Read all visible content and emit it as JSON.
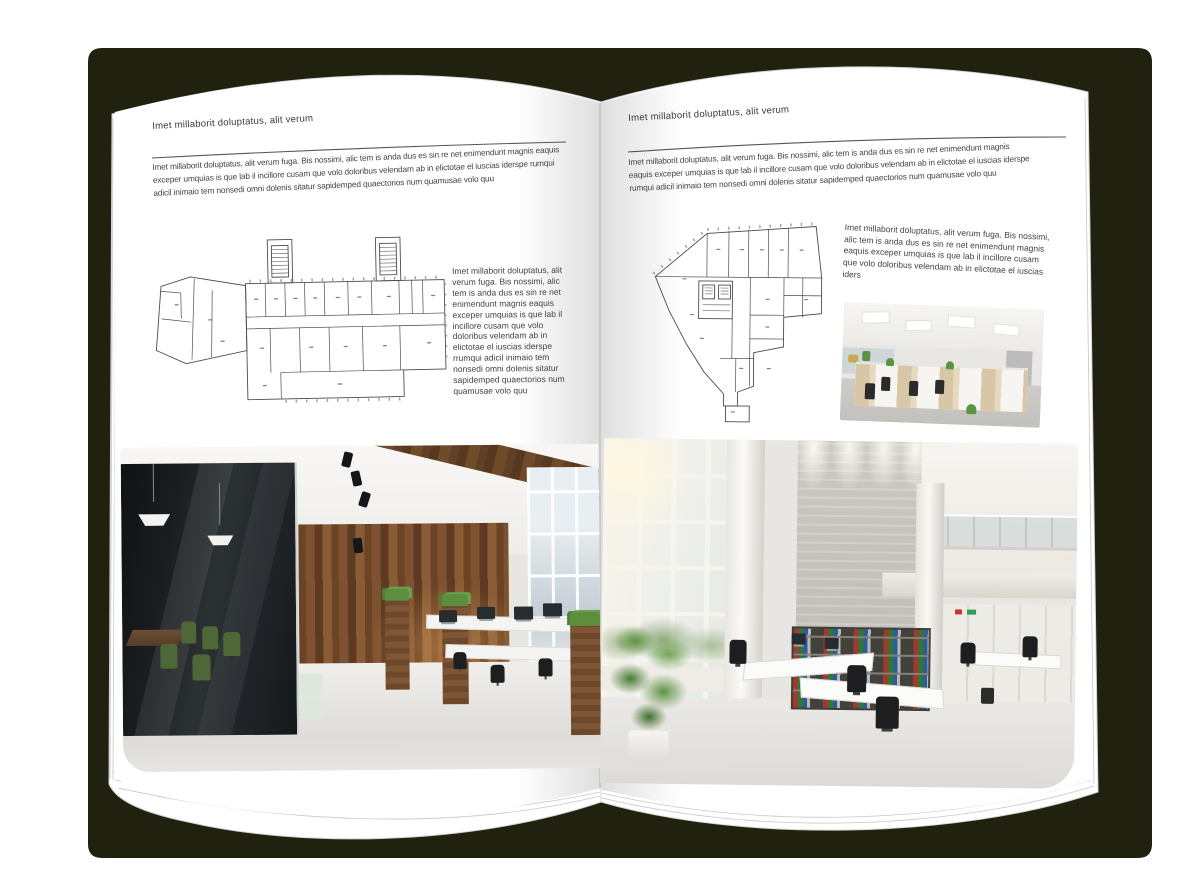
{
  "document": {
    "type": "brochure-spread-mockup"
  },
  "colors": {
    "background": "#ffffff",
    "cover": "#20210f",
    "page": "#ffffff",
    "heading": "#3a3a3a",
    "body_text": "#434343",
    "plan_lines": "#4a4a4a"
  },
  "left_page": {
    "header": "Imet millaborit doluptatus, alit verum",
    "intro": "Imet millaborit doluptatus, alit verum fuga. Bis nossimi, alic tem is anda dus es sin re net enimendunt magnis eaquis exceper umquias is que lab il incillore cusam que volo doloribus velendam ab in elictotae el iuscias iderspe rumqui adicil inimaio tem nonsedi omni dolenis sitatur sapidemped quaectorios num quamusae volo quu",
    "side_text": "Imet millaborit doluptatus, alit verum fuga. Bis nossimi, alic tem is anda dus es sin re net enimendunt magnis eaquis exceper umquias is que lab il incillore cusam que volo doloribus velendam ab in elictotae el iuscias iderspe rrumqui adicil inimaio tem nonsedi omni dolenis sitatur sapidemped quaectorios num quamusae volo quu",
    "floor_plan": "elongated-building-floor-plan",
    "photo": "loft-office-interior-photo"
  },
  "right_page": {
    "header": "Imet millaborit doluptatus, alit verum",
    "intro": "Imet millaborit doluptatus, alit verum fuga. Bis nossimi, alic tem is anda dus es sin re net enimendunt magnis eaquis exceper umquias is que lab il incillore cusam que volo doloribus velendam ab in elictotae el iuscias iderspe rumqui adicil inimaio tem nonsedi omni dolenis sitatur sapidemped quaectorios num quamusae volo quu",
    "side_text": "Imet millaborit doluptatus, alit verum fuga. Bis nossimi, alic tem is anda dus es sin re net enimendunt magnis eaquis exceper umquias is que lab il incillore cusam que volo doloribus velendam ab in elictotae el iuscias iders",
    "floor_plan": "irregular-tower-floor-plan",
    "photo_small": "open-plan-office-cubicles-photo",
    "photo": "bright-atrium-office-interior-photo"
  }
}
